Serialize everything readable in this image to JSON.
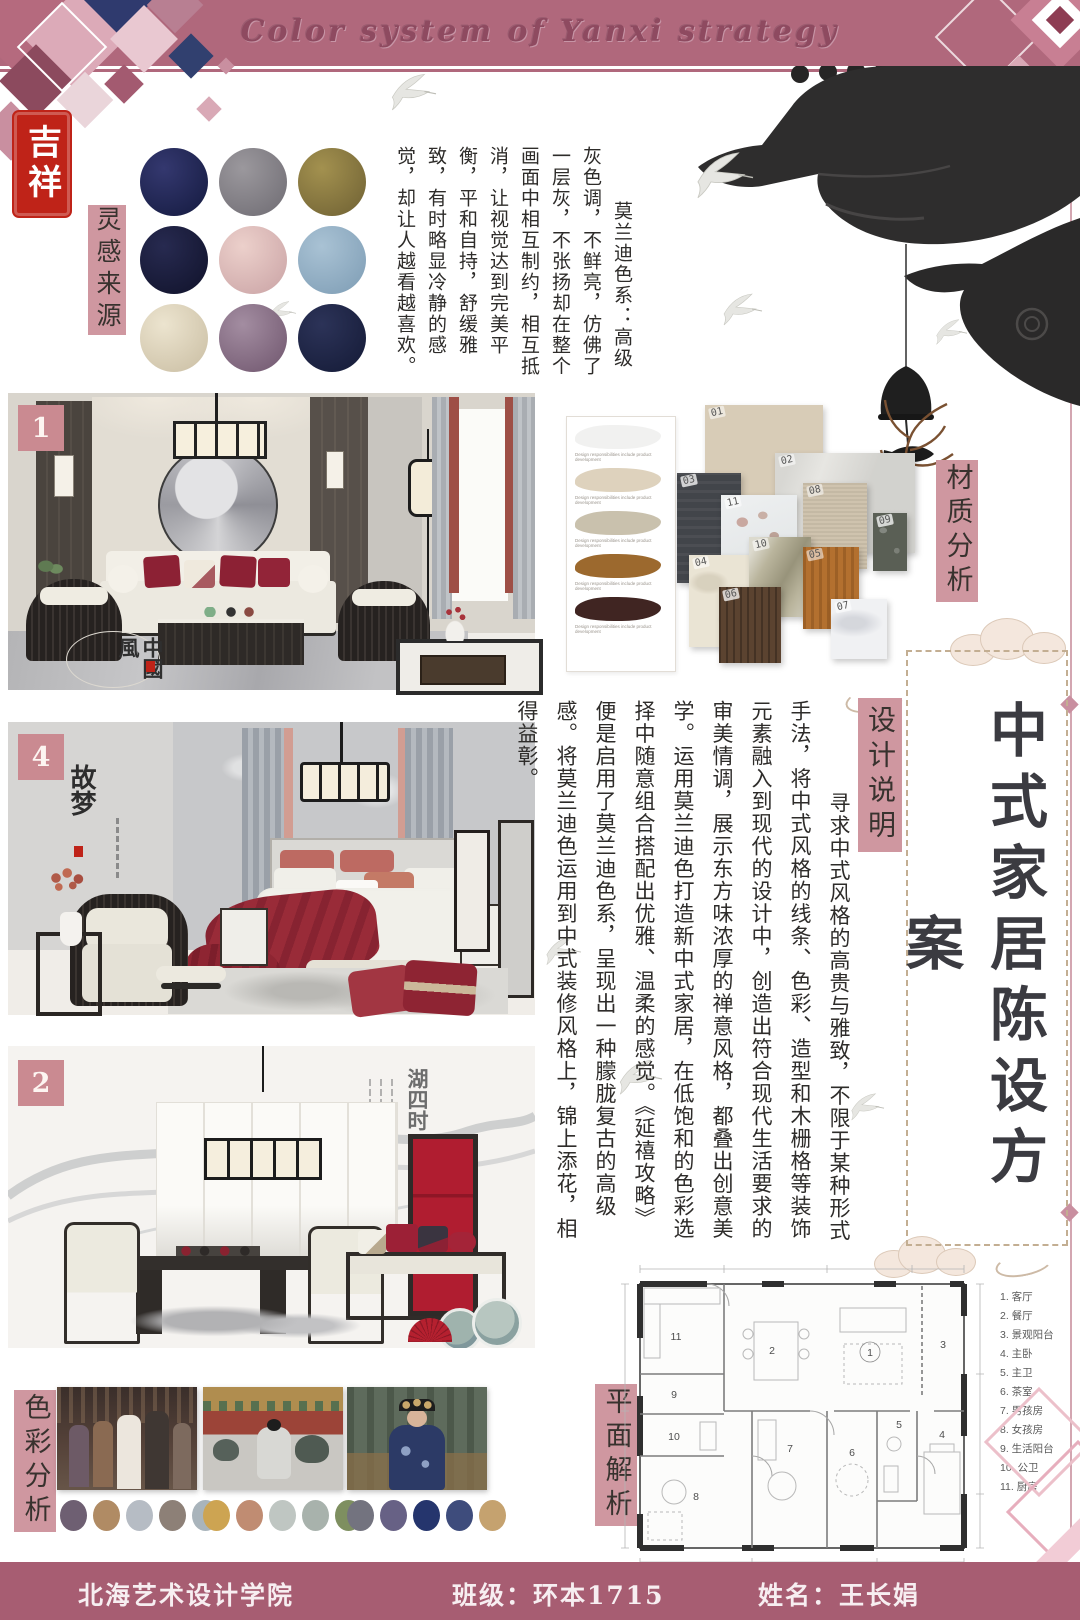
{
  "page": {
    "banner_title": "Color system of Yanxi strategy"
  },
  "seal": {
    "text": "吉祥"
  },
  "inspiration": {
    "label": "灵感来源",
    "note": "莫兰迪色系：高级灰色调，不鲜亮，仿佛了一层灰，不张扬却在整个画面中相互制约，相互抵消，让视觉达到完美平衡，平和自持，舒缓雅致，有时略显冷静的感觉，却让人越看越喜欢。",
    "circles": [
      [
        "#34386f",
        "#141a3f"
      ],
      [
        "#9b989d",
        "#6e6b72"
      ],
      [
        "#a3914f",
        "#6e6033"
      ],
      [
        "#272a50",
        "#10122a"
      ],
      [
        "#ecd0cb",
        "#c9a2a4"
      ],
      [
        "#a9c2d4",
        "#7d9cb4"
      ],
      [
        "#ece4cf",
        "#c9bda2"
      ],
      [
        "#a38da1",
        "#6f556d"
      ],
      [
        "#2c3358",
        "#141a36"
      ]
    ]
  },
  "sections": {
    "living": {
      "number": "1",
      "artwork_text": "中國風"
    },
    "bedroom": {
      "number": "4",
      "artwork_text": "故梦"
    },
    "dining": {
      "number": "2",
      "artwork_text": "湖四时"
    }
  },
  "material": {
    "label": "材质分析",
    "paint_caption": "Design responsibilities include product development",
    "paints": [
      "#f1f1f0",
      "#ded2bd",
      "#c9c1ad",
      "#9c692e",
      "#402522"
    ],
    "swatches": [
      {
        "id": "01",
        "color": "#d8ccb7"
      },
      {
        "id": "02",
        "color": "#e7e6e2"
      },
      {
        "id": "03",
        "color": "#42454a"
      },
      {
        "id": "04",
        "color": "#eae4d4"
      },
      {
        "id": "05",
        "color": "#b3702f"
      },
      {
        "id": "06",
        "color": "#5b4330"
      },
      {
        "id": "07",
        "color": "#f0f1f3"
      },
      {
        "id": "08",
        "color": "#cfc3ae"
      },
      {
        "id": "09",
        "color": "#5a5f55"
      },
      {
        "id": "10",
        "color": "#b9b49c"
      },
      {
        "id": "11",
        "color": ""
      }
    ]
  },
  "design_note": {
    "label": "设计说明",
    "text": "寻求中式风格的高贵与雅致，不限于某种形式手法，将中式风格的线条、色彩、造型和木栅格等装饰元素融入到现代的设计中，创造出符合现代生活要求的审美情调，展示东方味浓厚的禅意风格，都叠出创意美学。运用莫兰迪色打造新中式家居，在低饱和的色彩选择中随意组合搭配出优雅、温柔的感觉。《延禧攻略》便是启用了莫兰迪色系，呈现出一种朦胧复古的高级感。将莫兰迪色运用到中式装修风格上，锦上添花，相得益彰。"
  },
  "main_title": {
    "text": "中式家居陈设方案"
  },
  "color_analysis": {
    "label": "色彩分析",
    "palettes": [
      [
        "#6e5f72",
        "#b08b64",
        "#b6bcc4",
        "#8d8077",
        "#a9b4bb"
      ],
      [
        "#cda452",
        "#c08c72",
        "#bfc6c2",
        "#a8b2ac",
        "#7e8f60"
      ],
      [
        "#73737f",
        "#676185",
        "#25356d",
        "#3e4c7c",
        "#c5a26f"
      ]
    ]
  },
  "floor_plan": {
    "label": "平面解析",
    "room_numbers": [
      "1",
      "2",
      "3",
      "4",
      "5",
      "6",
      "7",
      "8",
      "9",
      "10",
      "11"
    ],
    "legend": [
      "1. 客厅",
      "2. 餐厅",
      "3. 景观阳台",
      "4. 主卧",
      "5. 主卫",
      "6. 茶室",
      "7. 男孩房",
      "8. 女孩房",
      "9. 生活阳台",
      "10. 公卫",
      "11. 厨房"
    ]
  },
  "footer": {
    "school": "北海艺术设计学院",
    "class_label": "班级：环本1715",
    "name_label": "姓名：王长娟"
  }
}
